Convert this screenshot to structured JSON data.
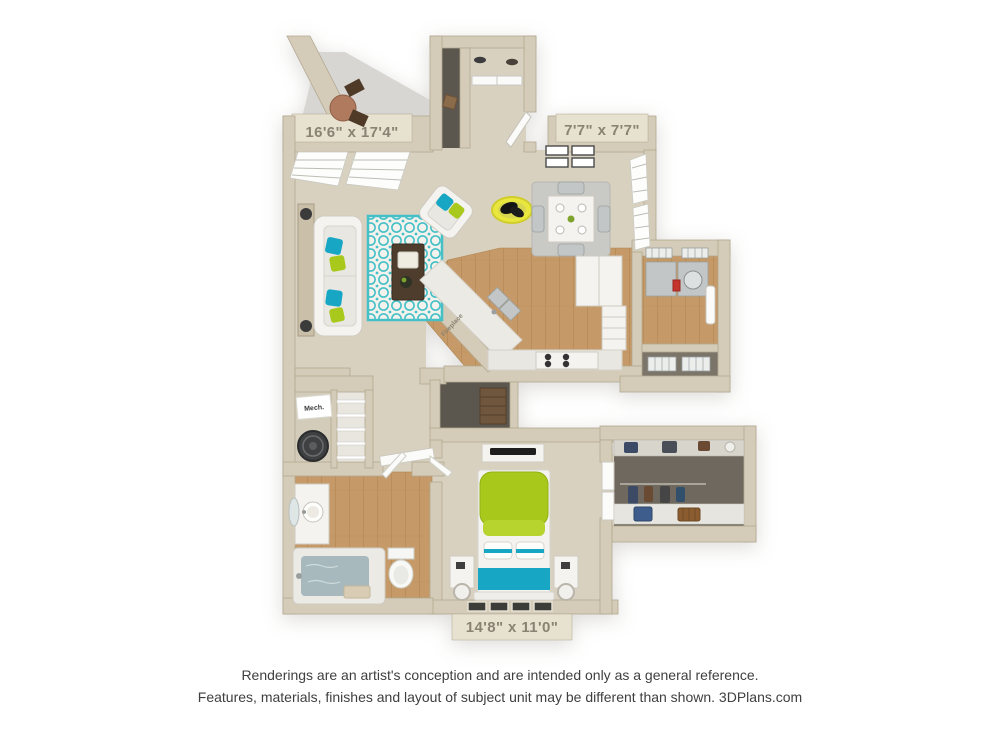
{
  "page": {
    "background_color": "#ffffff"
  },
  "floorplan": {
    "kind": "3D apartment floor plan rendering, top-down view",
    "dimension_labels": {
      "living_room": "16'6\" x 17'4\"",
      "dining_area": "7'7\" x 7'7\"",
      "bedroom": "14'8\" x 11'0\""
    },
    "labels": {
      "mechanical": "Mech.",
      "fireplace": "Fireplace"
    },
    "colors": {
      "wall": "#d4ccb8",
      "wall_edge": "#b3a892",
      "wall_tab": "#e7e1cf",
      "carpet": "#d8d1c0",
      "wood": "#c69a68",
      "wood_dark": "#b0854f",
      "balcony_gray": "#d7d6d2",
      "closet_dark": "#5b564e",
      "rug_teal": "#45c0c7",
      "rug_white": "#f4f2ec",
      "dining_rug": "#c9c9c5",
      "accent_lime": "#a8c91c",
      "accent_teal": "#17a6c4",
      "accent_yellow": "#e9e73e",
      "water_blue": "#a7b9bd",
      "label_text": "#8a8272",
      "disclaimer_text": "#3f3f3f"
    },
    "rooms": [
      {
        "name": "patio-balcony",
        "features": [
          "bistro-table",
          "two-folding-chairs"
        ]
      },
      {
        "name": "living-room",
        "features": [
          "sofa",
          "console-table",
          "table-lamps",
          "accent-pillows",
          "quatrefoil-rug",
          "coffee-table",
          "armchair",
          "dog-bed-with-dog",
          "fireplace",
          "window-blinds"
        ]
      },
      {
        "name": "entry-foyer",
        "features": [
          "coat-closet",
          "double-closet-doors",
          "shoe-shelf",
          "storage-closet",
          "front-door"
        ]
      },
      {
        "name": "dining-area",
        "features": [
          "dining-table",
          "four-chairs",
          "place-settings",
          "four-wall-frames",
          "window-blinds"
        ]
      },
      {
        "name": "kitchen",
        "features": [
          "angled-counter",
          "double-sink",
          "refrigerator",
          "cabinets",
          "stove"
        ]
      },
      {
        "name": "laundry-room",
        "features": [
          "washer",
          "dryer",
          "wire-shelving",
          "door"
        ]
      },
      {
        "name": "storage-closet",
        "features": [
          "wire-shelving"
        ]
      },
      {
        "name": "hallway",
        "features": [
          "dresser-nook",
          "console-shelf"
        ]
      },
      {
        "name": "mechanical-closet",
        "features": [
          "water-heater"
        ]
      },
      {
        "name": "linen-closet",
        "features": [
          "shelves"
        ]
      },
      {
        "name": "bathroom",
        "features": [
          "vanity-sink",
          "mirror",
          "bathtub",
          "toilet"
        ]
      },
      {
        "name": "bedroom",
        "features": [
          "bed",
          "lime-pillows",
          "teal-blanket",
          "nightstands",
          "ring-lamps",
          "tv-stand",
          "tv",
          "windows"
        ]
      },
      {
        "name": "walk-in-closet",
        "features": [
          "hanging-clothes",
          "shelf-bags",
          "suitcase",
          "basket"
        ]
      }
    ]
  },
  "disclaimer": {
    "line1": "Renderings are an artist's conception and are intended only as a general reference.",
    "line2": "Features, materials, finishes and layout of subject unit may be different than shown. 3DPlans.com"
  }
}
